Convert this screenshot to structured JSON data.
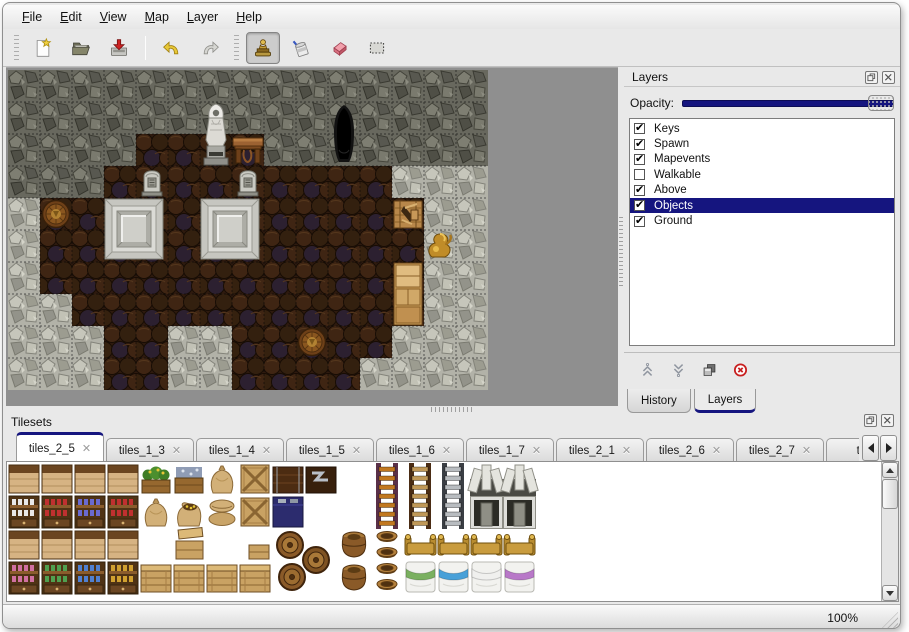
{
  "menu": {
    "items": [
      {
        "label": "File"
      },
      {
        "label": "Edit"
      },
      {
        "label": "View"
      },
      {
        "label": "Map"
      },
      {
        "label": "Layer"
      },
      {
        "label": "Help"
      }
    ]
  },
  "toolbar": {
    "buttons": [
      {
        "name": "new-map-button",
        "icon": "new",
        "group": 0
      },
      {
        "name": "open-map-button",
        "icon": "open",
        "group": 0
      },
      {
        "name": "save-map-button",
        "icon": "save",
        "group": 0
      },
      {
        "name": "undo-button",
        "icon": "undo",
        "group": 1
      },
      {
        "name": "redo-button",
        "icon": "redo",
        "group": 1
      },
      {
        "name": "stamp-tool-button",
        "icon": "stamp",
        "group": 2,
        "active": true
      },
      {
        "name": "fill-tool-button",
        "icon": "fill",
        "group": 2
      },
      {
        "name": "eraser-tool-button",
        "icon": "eraser",
        "group": 2
      },
      {
        "name": "select-tool-button",
        "icon": "select",
        "group": 2
      }
    ]
  },
  "layers_panel": {
    "title": "Layers",
    "opacity_label": "Opacity:",
    "opacity_percent": 100,
    "layers": [
      {
        "label": "Keys",
        "checked": true,
        "selected": false
      },
      {
        "label": "Spawn",
        "checked": true,
        "selected": false
      },
      {
        "label": "Mapevents",
        "checked": true,
        "selected": false
      },
      {
        "label": "Walkable",
        "checked": false,
        "selected": false
      },
      {
        "label": "Above",
        "checked": true,
        "selected": false
      },
      {
        "label": "Objects",
        "checked": true,
        "selected": true
      },
      {
        "label": "Ground",
        "checked": true,
        "selected": false
      }
    ],
    "buttons": [
      {
        "name": "move-layer-up-button",
        "icon": "up"
      },
      {
        "name": "move-layer-down-button",
        "icon": "down"
      },
      {
        "name": "duplicate-layer-button",
        "icon": "duplicate"
      },
      {
        "name": "delete-layer-button",
        "icon": "delete"
      }
    ],
    "tabs": [
      {
        "label": "History",
        "active": false
      },
      {
        "label": "Layers",
        "active": true
      }
    ]
  },
  "tilesets_panel": {
    "title": "Tilesets",
    "close_glyph": "✕",
    "tabs": [
      {
        "label": "tiles_2_5",
        "active": true
      },
      {
        "label": "tiles_1_3",
        "active": false
      },
      {
        "label": "tiles_1_4",
        "active": false
      },
      {
        "label": "tiles_1_5",
        "active": false
      },
      {
        "label": "tiles_1_6",
        "active": false
      },
      {
        "label": "tiles_1_7",
        "active": false
      },
      {
        "label": "tiles_2_1",
        "active": false
      },
      {
        "label": "tiles_2_6",
        "active": false
      },
      {
        "label": "tiles_2_7",
        "active": false
      },
      {
        "label": "tiles_",
        "active": false,
        "truncated": true
      }
    ]
  },
  "status_bar": {
    "zoom_level": "100%"
  },
  "colors": {
    "selection_navy": "#15157f",
    "delete_red": "#c82020",
    "map_background": "#8f8f8f",
    "floor_brown": "#2e1a0e",
    "rock_dark": "#68685e",
    "rock_light": "#b2b2a8"
  },
  "map": {
    "tile_size": 32,
    "legend": {
      "D": "dark-rock-wall",
      "L": "light-rock-floor",
      "F": "wood-plank-floor"
    },
    "grid": [
      "DDDDDDDDDDDDDDD",
      "DDDDDDDDDDDDDDD",
      "DDDDFFFFDDDDDDD",
      "DDDFFFFFFFFFLLL",
      "LFFFFFFFFFFFFLL",
      "LFFFFFFFFFFFFLL",
      "LFFFFFFFFFFFFLL",
      "LLFFFFFFFFFFFLL",
      "LLLFFLLFFFFFLLL",
      "LLLFFLLFFFFLLLL"
    ],
    "objects": [
      {
        "type": "statue",
        "x": 192,
        "y": 32
      },
      {
        "type": "table",
        "x": 224,
        "y": 64
      },
      {
        "type": "cave",
        "x": 320,
        "y": 32
      },
      {
        "type": "grave",
        "x": 128,
        "y": 96
      },
      {
        "type": "grave",
        "x": 224,
        "y": 96
      },
      {
        "type": "tomb",
        "x": 96,
        "y": 128
      },
      {
        "type": "tomb",
        "x": 192,
        "y": 128
      },
      {
        "type": "barrel",
        "x": 32,
        "y": 128
      },
      {
        "type": "crate",
        "x": 384,
        "y": 128
      },
      {
        "type": "vase",
        "x": 416,
        "y": 160
      },
      {
        "type": "cabinet",
        "x": 384,
        "y": 192
      },
      {
        "type": "barrel",
        "x": 288,
        "y": 256
      }
    ]
  },
  "tileset_content": {
    "tile_size": 33,
    "cells": [
      {
        "t": "shelftop",
        "c": 0,
        "r": 0
      },
      {
        "t": "shelftop",
        "c": 1,
        "r": 0
      },
      {
        "t": "shelftop",
        "c": 2,
        "r": 0
      },
      {
        "t": "shelftop",
        "c": 3,
        "r": 0
      },
      {
        "t": "plantbox",
        "c": 4,
        "r": 0
      },
      {
        "t": "fishcrate",
        "c": 5,
        "r": 0
      },
      {
        "t": "sack",
        "c": 6,
        "r": 0
      },
      {
        "t": "cratex",
        "c": 7,
        "r": 0
      },
      {
        "t": "darkchest",
        "c": 8,
        "r": 0
      },
      {
        "t": "metalchest",
        "c": 9,
        "r": 0
      },
      {
        "t": "ladder",
        "c": 11,
        "r": 0,
        "rail": "#5a3048",
        "accent": "#c27820"
      },
      {
        "t": "ladder",
        "c": 12,
        "r": 0,
        "rail": "#4a2c14",
        "accent": "#c09858"
      },
      {
        "t": "ladder",
        "c": 13,
        "r": 0,
        "rail": "#3a3e44",
        "accent": "#b8bcc0"
      },
      {
        "t": "arch",
        "c": 14,
        "r": 0
      },
      {
        "t": "arch",
        "c": 15,
        "r": 0
      },
      {
        "t": "shelfbody",
        "c": 0,
        "r": 1,
        "accent": "#e8e8e8"
      },
      {
        "t": "shelfbody",
        "c": 1,
        "r": 1,
        "accent": "#c03030"
      },
      {
        "t": "shelfbody",
        "c": 2,
        "r": 1,
        "accent": "#6a6ad0"
      },
      {
        "t": "shelfbody",
        "c": 3,
        "r": 1,
        "accent": "#c03030"
      },
      {
        "t": "sack",
        "c": 4,
        "r": 1
      },
      {
        "t": "sackopen",
        "c": 5,
        "r": 1
      },
      {
        "t": "sackstack",
        "c": 6,
        "r": 1
      },
      {
        "t": "cratex",
        "c": 7,
        "r": 1
      },
      {
        "t": "bluecrate",
        "c": 8,
        "r": 1
      },
      {
        "t": "hearth",
        "c": 14,
        "r": 1
      },
      {
        "t": "hearth",
        "c": 15,
        "r": 1
      },
      {
        "t": "shelftop",
        "c": 0,
        "r": 2
      },
      {
        "t": "shelftop",
        "c": 1,
        "r": 2
      },
      {
        "t": "shelftop",
        "c": 2,
        "r": 2
      },
      {
        "t": "shelftop",
        "c": 3,
        "r": 2
      },
      {
        "t": "cratelid",
        "c": 5,
        "r": 2
      },
      {
        "t": "cratesmall",
        "c": 7,
        "r": 2
      },
      {
        "t": "barrelcluster",
        "c": 8,
        "r": 2
      },
      {
        "t": "barrelup",
        "c": 10,
        "r": 2
      },
      {
        "t": "pots",
        "c": 11,
        "r": 2
      },
      {
        "t": "bedhead",
        "c": 12,
        "r": 2
      },
      {
        "t": "bedhead",
        "c": 13,
        "r": 2
      },
      {
        "t": "bedhead",
        "c": 14,
        "r": 2
      },
      {
        "t": "bedhead",
        "c": 15,
        "r": 2
      },
      {
        "t": "shelfbody",
        "c": 0,
        "r": 3,
        "accent": "#d070a0"
      },
      {
        "t": "shelfbody",
        "c": 1,
        "r": 3,
        "accent": "#50a050"
      },
      {
        "t": "shelfbody",
        "c": 2,
        "r": 3,
        "accent": "#5080d0"
      },
      {
        "t": "shelfbody",
        "c": 3,
        "r": 3,
        "accent": "#d0a030"
      },
      {
        "t": "crate",
        "c": 4,
        "r": 3
      },
      {
        "t": "crate",
        "c": 5,
        "r": 3
      },
      {
        "t": "crate",
        "c": 6,
        "r": 3
      },
      {
        "t": "crate",
        "c": 7,
        "r": 3
      },
      {
        "t": "barrelup",
        "c": 10,
        "r": 3
      },
      {
        "t": "bedfoot",
        "c": 12,
        "r": 3,
        "accent": "#7ab060"
      },
      {
        "t": "bedfoot",
        "c": 13,
        "r": 3,
        "accent": "#48a0d8"
      },
      {
        "t": "bedfoot",
        "c": 14,
        "r": 3,
        "accent": "#f0f0ee"
      },
      {
        "t": "bedfoot",
        "c": 15,
        "r": 3,
        "accent": "#b878c8"
      }
    ]
  }
}
